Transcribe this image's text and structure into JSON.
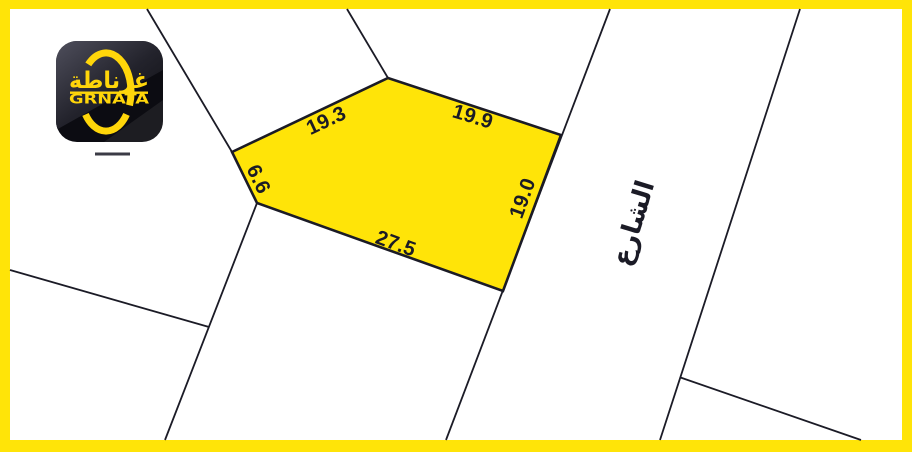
{
  "colors": {
    "frame": "#ffe408",
    "parcel_fill": "#ffe408",
    "ink": "#1b1b26",
    "logo_accent": "#ffd60a",
    "logo_tile": "#0c0c12"
  },
  "logo": {
    "brand_arabic": "غرناطة",
    "brand_latin": "GRNATA"
  },
  "parcel": {
    "dimensions": [
      {
        "position": "top-left",
        "value": "19.3"
      },
      {
        "position": "top-right",
        "value": "19.9"
      },
      {
        "position": "right",
        "value": "19.0"
      },
      {
        "position": "bottom",
        "value": "27.5"
      },
      {
        "position": "left",
        "value": "6.6"
      }
    ]
  },
  "street": {
    "label": "الشارع"
  }
}
